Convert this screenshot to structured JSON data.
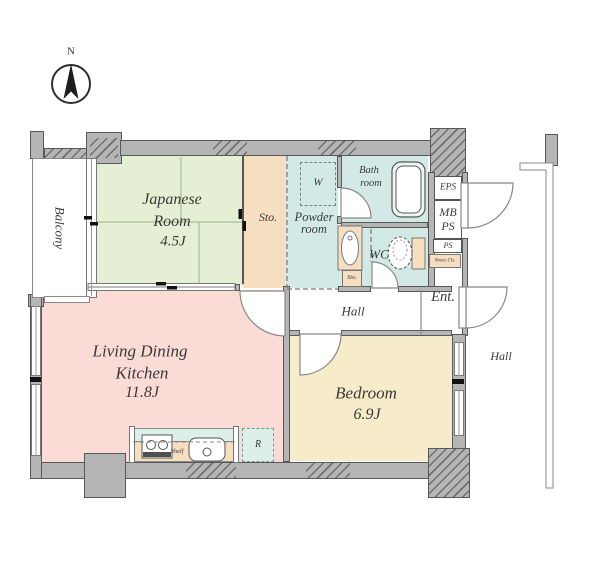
{
  "labels": {
    "north": "N",
    "balcony": "Balcony",
    "japanese1": "Japanese",
    "japanese2": "Room",
    "japanese_size": "4.5J",
    "sto": "Sto.",
    "w": "W",
    "powder1": "Powder",
    "powder2": "room",
    "bath1": "Bath",
    "bath2": "room",
    "wc": "WC",
    "sto_small": "Sto.",
    "eps": "EPS",
    "mb1": "MB",
    "mb2": "PS",
    "ps": "PS",
    "shoes": "Shoes Cls.",
    "ent": "Ent.",
    "hall": "Hall",
    "hall_outer": "Hall",
    "ldk1": "Living Dining",
    "ldk2": "Kitchen",
    "ldk_size": "11.8J",
    "bedroom": "Bedroom",
    "bedroom_size": "6.9J",
    "shelf": "Shelf",
    "fridge": "R"
  },
  "colors": {
    "wall": "#b5b5b5",
    "wall_edge": "#585858",
    "japanese_room": "#e4efd4",
    "storage": "#f5dfc0",
    "wet_area": "#d2e9e5",
    "ldk": "#fadbd6",
    "bedroom": "#f6ecca",
    "kitchen_top": "#ddefe9",
    "text": "#3a3a3a"
  }
}
